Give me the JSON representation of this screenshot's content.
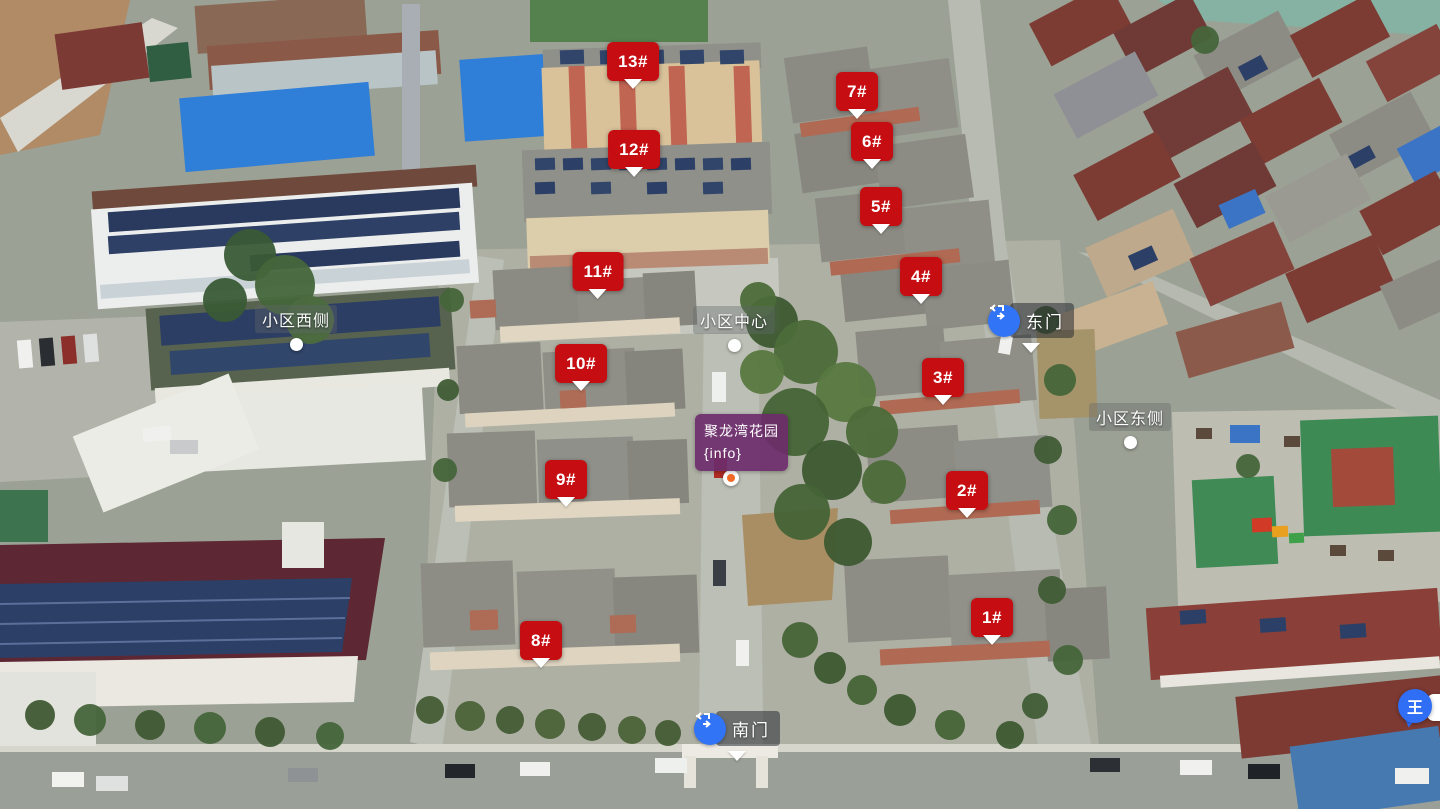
{
  "viewer": {
    "community_name": "聚龙湾花园"
  },
  "building_markers": [
    {
      "label": "1#"
    },
    {
      "label": "2#"
    },
    {
      "label": "3#"
    },
    {
      "label": "4#"
    },
    {
      "label": "5#"
    },
    {
      "label": "6#"
    },
    {
      "label": "7#"
    },
    {
      "label": "8#"
    },
    {
      "label": "9#"
    },
    {
      "label": "10#"
    },
    {
      "label": "11#"
    },
    {
      "label": "12#"
    },
    {
      "label": "13#"
    }
  ],
  "gate_markers": [
    {
      "label": "南门"
    },
    {
      "label": "东门"
    }
  ],
  "area_labels": [
    {
      "label": "小区西侧"
    },
    {
      "label": "小区中心"
    },
    {
      "label": "小区东侧"
    }
  ],
  "info_card": {
    "title": "聚龙湾花园",
    "subtitle": "{info}"
  },
  "im_widget": {
    "avatar_text": "王"
  },
  "colors": {
    "marker_red": "#c50d12",
    "gate_blue": "#3274f6",
    "info_purple": "#6c2c6b",
    "pin_orange": "#f06a26"
  }
}
